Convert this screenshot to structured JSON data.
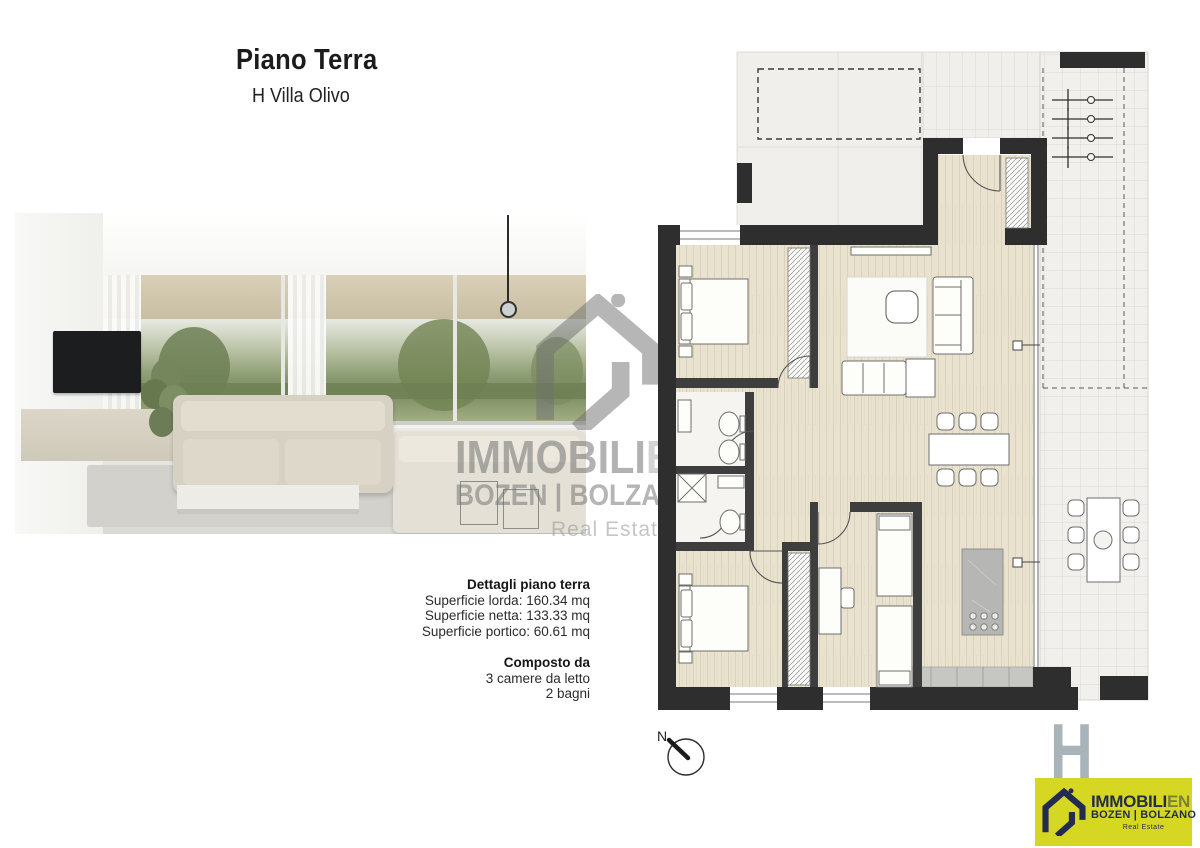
{
  "header": {
    "title": "Piano Terra",
    "subtitle": "H Villa Olivo"
  },
  "details": {
    "heading": "Dettagli piano terra",
    "lines": [
      "Superficie lorda: 160.34 mq",
      "Superficie netta: 133.33 mq",
      "Superficie portico: 60.61 mq"
    ]
  },
  "composition": {
    "heading": "Composto da",
    "lines": [
      "3 camere da letto",
      "2 bagni"
    ]
  },
  "watermark": {
    "brand": "IMMOBILI",
    "brand_suffix": "EN",
    "cities": "BOZEN | BOLZANO",
    "tagline": "Real Estate"
  },
  "floorplan": {
    "compass_label": "N",
    "unit_letter": "H",
    "colors": {
      "wall": "#2e2e2e",
      "partition": "#3e3e3e",
      "wood_floor": "#e8e2cf",
      "terrace_tile": "#f1f0ec",
      "patio_concrete": "#f0efeb",
      "kitchen_island": "#b6b6b4",
      "unit_letter_gray": "#a9b3ba"
    }
  },
  "logo": {
    "brand": "IMMOBILI",
    "brand_suffix": "EN",
    "cities": "BOZEN | BOLZANO",
    "tagline": "Real Estate",
    "colors": {
      "background": "#d6d723",
      "navy": "#232c50"
    }
  }
}
